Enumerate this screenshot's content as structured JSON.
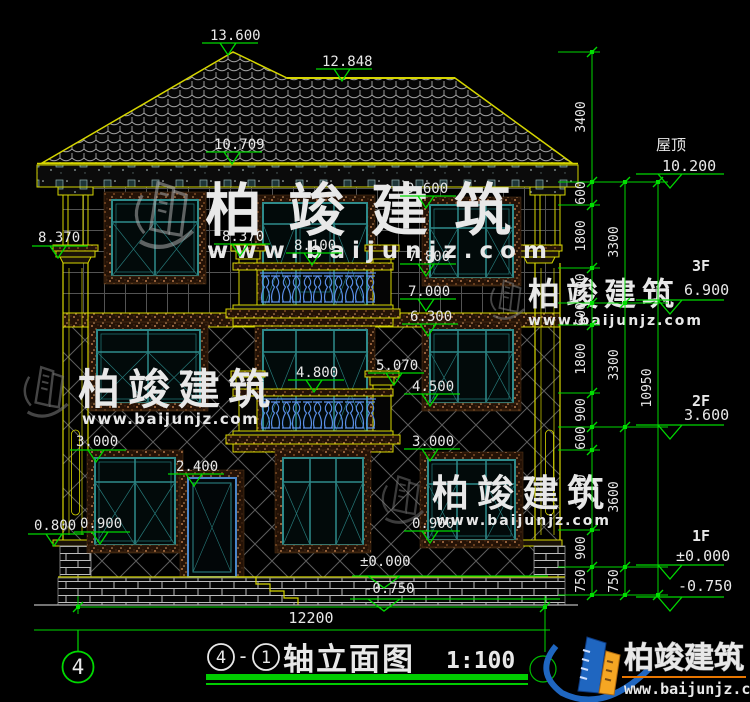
{
  "drawing": {
    "annotations": {
      "ridge": "13.600",
      "ridge2": "12.848",
      "eave": "10.709",
      "w3_top": "9.600",
      "cap_left": "8.370",
      "post3_cap": "8.370",
      "door3_top": "8.100",
      "rail3": "7.800",
      "floor3_slab": "7.000",
      "band2": "6.300",
      "post2_cap": "5.070",
      "rail2": "4.800",
      "sill2": "4.500",
      "w1_top_left": "3.000",
      "w1_top_right": "3.000",
      "door1_top": "2.400",
      "sill1_left": "0.900",
      "sill1_right": "0.900",
      "plinth": "0.800",
      "ground": "±0.000",
      "below_ground": "-0.750"
    },
    "levels": {
      "roof": {
        "label": "屋顶",
        "value": "10.200"
      },
      "f3": {
        "label": "3F",
        "value": "6.900"
      },
      "f2": {
        "label": "2F",
        "value": "3.600"
      },
      "f1": {
        "label": "1F",
        "value": "±0.000"
      },
      "base": {
        "value": "-0.750"
      }
    },
    "dims": {
      "col1": [
        "3400",
        "600",
        "1800",
        "900",
        "600",
        "1800",
        "900",
        "600",
        "2100",
        "900",
        "750"
      ],
      "col2": [
        "3300",
        "3300",
        "3600",
        "750"
      ],
      "col3": "10950",
      "width": "12200"
    },
    "axis_bubble": "4"
  },
  "title_block": {
    "axis_a": "4",
    "separator": "-",
    "axis_b": "1",
    "name": "轴立面图",
    "scale": "1:100"
  },
  "brand": {
    "name": "柏竣建筑",
    "url": "www.baijunjz.com"
  },
  "colors": {
    "annotation_green": "#00d800",
    "structure_yellow": "#d6d600",
    "window_teal": "#2e8b8b",
    "baluster_blue": "#5b8fe8",
    "logo_blue": "#1f66c0",
    "logo_orange": "#f5a623",
    "url_orange": "#f08010"
  }
}
